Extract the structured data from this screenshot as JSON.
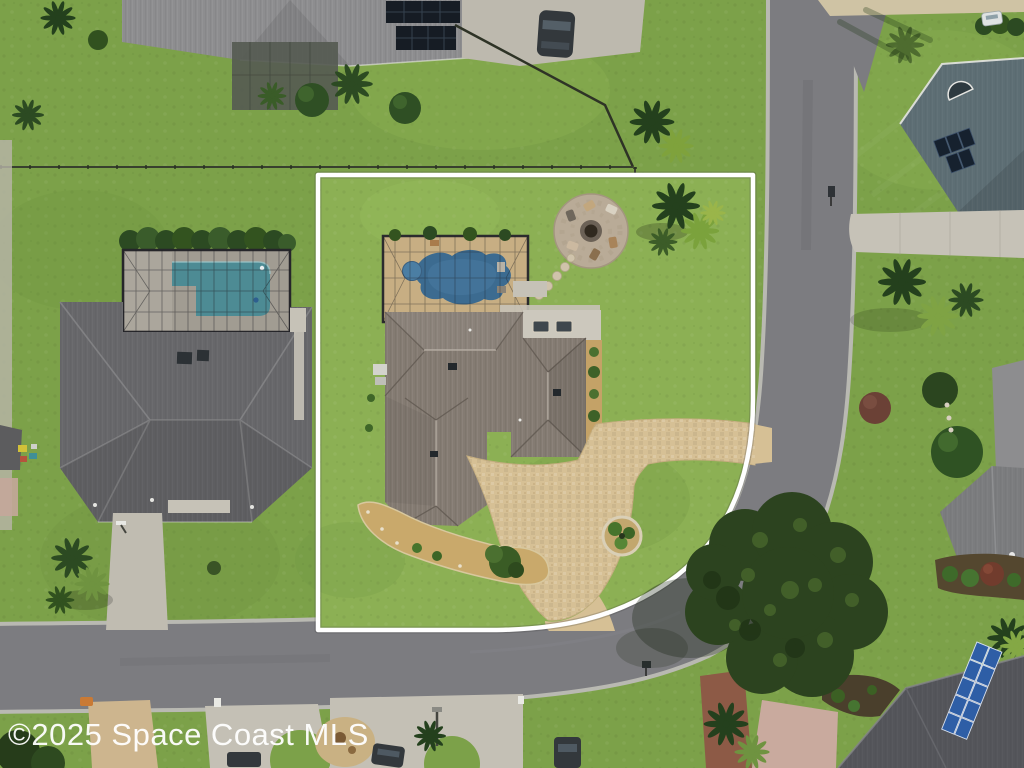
{
  "watermark": {
    "text": "©2025 Space Coast MLS"
  },
  "image_type": "aerial-drone-photograph",
  "scene": {
    "setting": "overhead aerial view of a suburban corner lot outlined with a white property-boundary line",
    "subject_property": {
      "boundary_color": "#ffffff",
      "features": [
        "screened pool enclosure with freeform blue pool and spa",
        "tan pool deck",
        "circular paver fire-pit patio with chairs",
        "stepping-stone path",
        "taupe metal hip-roof house",
        "covered lanai with two loungers",
        "tan paver circular driveway with two street aprons",
        "round landscape island",
        "crescent mulch bed with small tree",
        "palm cluster in rear corner"
      ]
    },
    "neighbors": [
      "top house with dark rooftop solar panels, concrete driveway and parked dark car",
      "west house with large gray hip roof, screened rectangular teal pool, hedge row, driveway with basketball hoop",
      "northeast house with blue-gray roof, arched gable vent and solar panels",
      "east yard with palms, purple-leaf shrub and gray roof edge",
      "southeast house with gray roof, garden bed and red-leaf bush",
      "bottom-right house with dark roof and blue solar array"
    ],
    "roads": [
      "curved residential street wrapping the east and south sides of the corner lot",
      "driveway aprons and mailboxes along far side of street"
    ],
    "vehicles": [
      "dark sedan on top driveway",
      "dark cars parked along bottom street",
      "small white vehicle top right"
    ],
    "vegetation": [
      "large live-oak tree overhanging the street corner",
      "multiple palm clusters",
      "round shrubs and hedges",
      "mowed green lawns"
    ]
  },
  "colors": {
    "grass": "#7ca149",
    "lot_grass": "#8cb054",
    "asphalt": "#7c7c80",
    "curb": "#b9b9b2",
    "boundary": "#ffffff",
    "concrete": "#c6c2b7",
    "pavers": "#d6c095",
    "mulch": "#c4a267",
    "fire_pit_patio": "#b9ab97",
    "subject_roof": "#847b72",
    "neighbor_roof_west": "#67676a",
    "neighbor_roof_ne": "#5d6e74",
    "pool_water": "#3c6b90",
    "neighbor_pool_water": "#4d8b94",
    "solar_panel_dark": "#161c24",
    "solar_panel_blue": "#2e5ea6",
    "tree_dark": "#2c431f",
    "tree_light": "#7fa344",
    "red_tree": "#713c2d",
    "sand": "#cfc3a4",
    "car_dark": "#33383c"
  }
}
